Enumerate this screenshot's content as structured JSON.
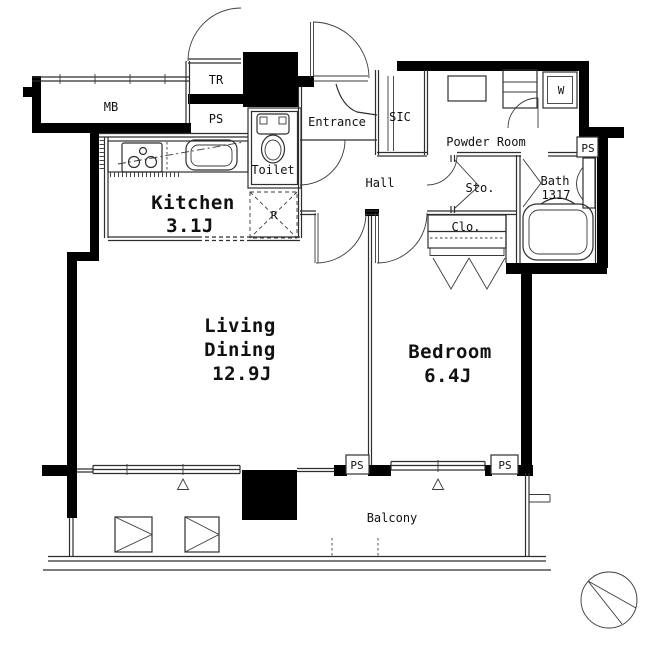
{
  "plan": {
    "rooms": {
      "meter_box": "MB",
      "trunk_room": "TR",
      "toilet": "Toilet",
      "entrance": "Entrance",
      "sic": "SIC",
      "powder_room": "Powder Room",
      "hall": "Hall",
      "storage": "Sto.",
      "bath": "Bath",
      "bath_size": "1317",
      "closet": "Clo.",
      "kitchen": "Kitchen",
      "kitchen_size": "3.1J",
      "living_line1": "Living",
      "living_line2": "Dining",
      "living_size": "12.9J",
      "bedroom": "Bedroom",
      "bedroom_size": "6.4J",
      "balcony": "Balcony"
    },
    "fixtures": {
      "pipe_space": "PS",
      "washer": "W",
      "refrigerator": "R"
    },
    "colors": {
      "background": "#ffffff",
      "wall": "#000000",
      "line": "#2e2e2e",
      "text": "#111111"
    }
  }
}
